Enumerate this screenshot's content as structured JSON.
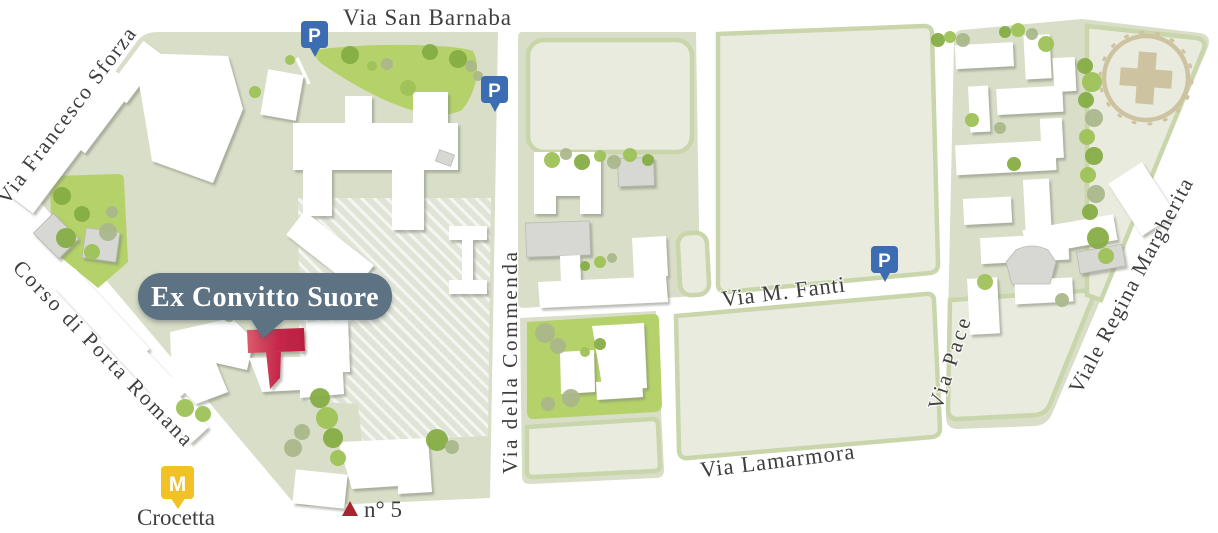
{
  "map": {
    "poi": {
      "label": "Ex Convitto Suore"
    },
    "streets": {
      "san_barnaba": "Via San Barnaba",
      "francesco_sforza": "Via Francesco Sforza",
      "porta_romana": "Corso di Porta Romana",
      "commenda": "Via della Commenda",
      "fanti": "Via M. Fanti",
      "lamarmora": "Via Lamarmora",
      "pace": "Via Pace",
      "regina_margherita": "Viale Regina Margherita"
    },
    "markers": {
      "parking": "P",
      "metro": "M",
      "metro_station": "Crocetta",
      "house_number": "n° 5"
    },
    "colors": {
      "land": "#d8dec7",
      "field": "#e9ebdf",
      "field_border": "#c9d5aa",
      "park": "#b4d269",
      "tree_dark": "#86ad45",
      "tree_mid": "#9fc258",
      "tree_muted": "#abb88c",
      "building": "#ffffff",
      "building_gray": "#d7d7d3",
      "hatch_base": "#e0e4d7",
      "hatch_stripe": "#f5f6f1",
      "highlight_red": "#c5274a",
      "highlight_red_light": "#dd5a6c",
      "bubble": "#5d7384",
      "parking_blue": "#3c6cb2",
      "metro_yellow": "#f1c125",
      "street_text": "#3f3e3c",
      "cross_beige": "#cdc3a1"
    }
  }
}
